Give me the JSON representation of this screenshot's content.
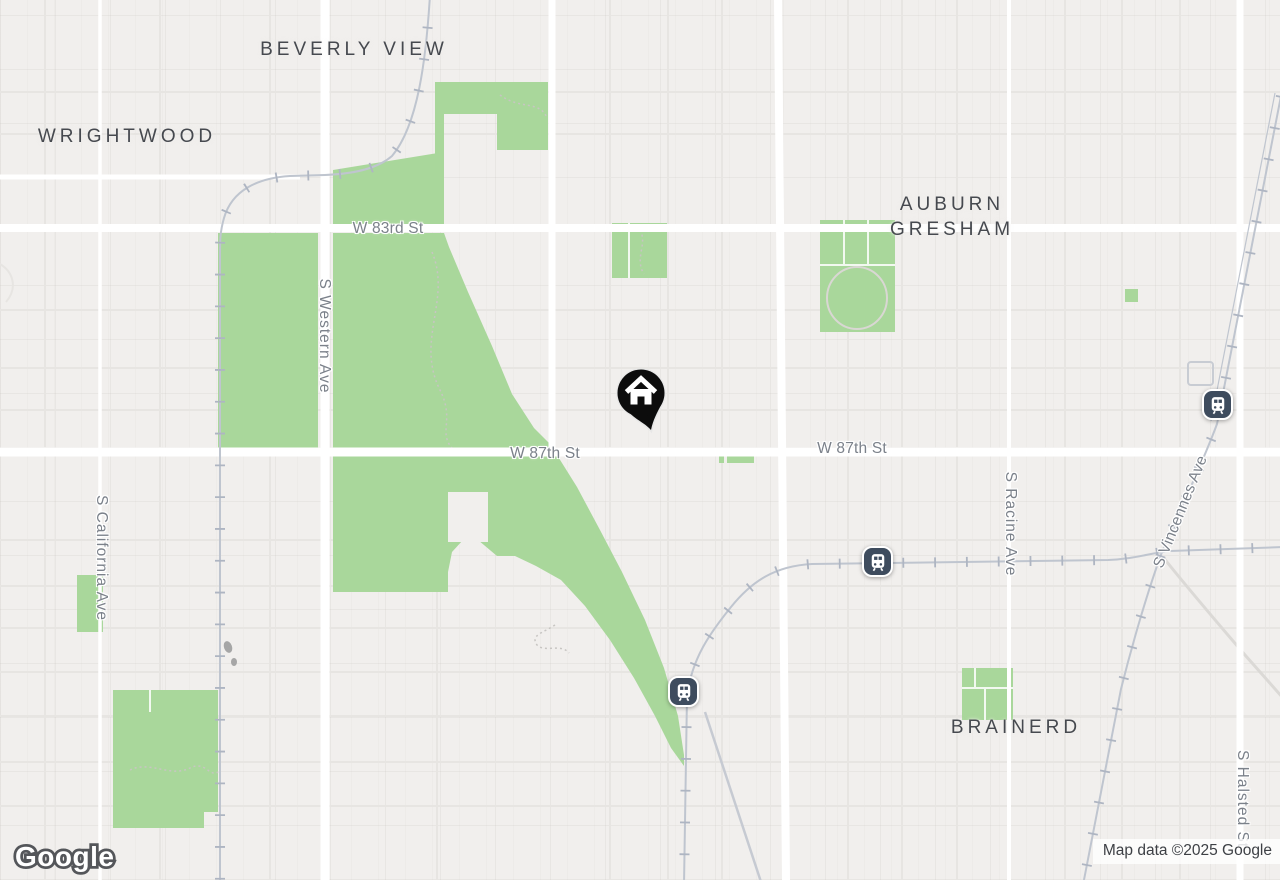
{
  "neighborhood_labels": [
    {
      "label": "BEVERLY VIEW"
    },
    {
      "label": "WRIGHTWOOD"
    },
    {
      "label": "AUBURN GRESHAM"
    },
    {
      "label": "BRAINERD"
    }
  ],
  "road_labels": [
    {
      "label": "W 83rd St",
      "orientation": "horizontal"
    },
    {
      "label": "W 87th St",
      "orientation": "horizontal"
    },
    {
      "label": "W 87th St",
      "orientation": "horizontal"
    },
    {
      "label": "S Western Ave",
      "orientation": "vertical"
    },
    {
      "label": "S California Ave",
      "orientation": "vertical"
    },
    {
      "label": "S Racine Ave",
      "orientation": "vertical"
    },
    {
      "label": "S Vincennes Ave",
      "orientation": "diagonal"
    },
    {
      "label": "S Halsted St",
      "orientation": "vertical"
    }
  ],
  "markers": {
    "home": {
      "icon": "home-pin-icon",
      "color": "#0c0c0c"
    },
    "transit_stations": {
      "icon": "train-station-icon",
      "count": 3,
      "color": "#3e4c5e"
    }
  },
  "branding": {
    "logo": "Google"
  },
  "attribution": {
    "text": "Map data ©2025 Google"
  },
  "colors": {
    "background": "#f1efed",
    "park_green": "#a9d79b",
    "road_white": "#ffffff",
    "railway_gray": "#bfc5cf",
    "road_label_gray": "#7b818a",
    "neighborhood_label_gray": "#46494f",
    "station_blue": "#3e4c5e"
  }
}
